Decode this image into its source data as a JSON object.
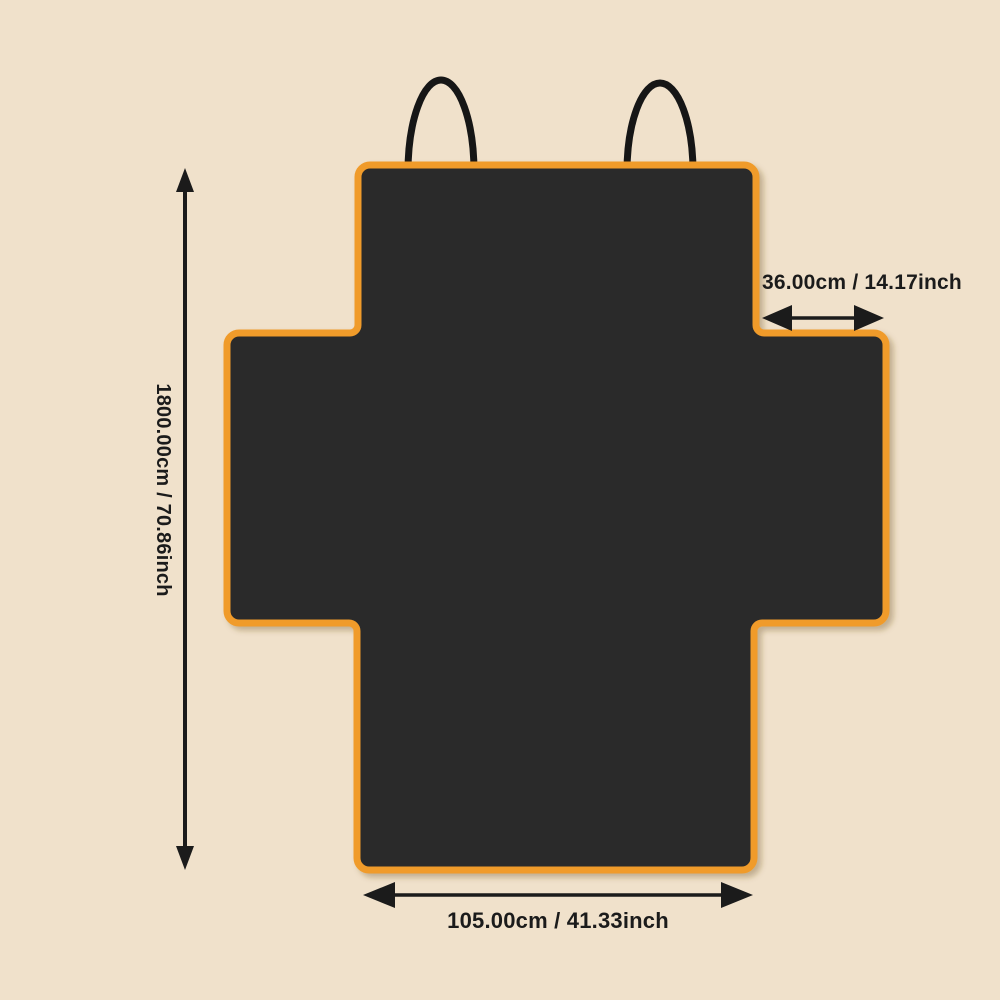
{
  "diagram": {
    "dimensions": {
      "height_label": "1800.00cm / 70.86inch",
      "top_width_label": "36.00cm / 14.17inch",
      "bottom_width_label": "105.00cm / 41.33inch"
    },
    "colors": {
      "background": "#F0E1CB",
      "cover_fill": "#2B2B2B",
      "trim_orange": "#F09B2C",
      "strap_ink": "#161616",
      "annotation_ink": "#1B1B1B"
    }
  }
}
